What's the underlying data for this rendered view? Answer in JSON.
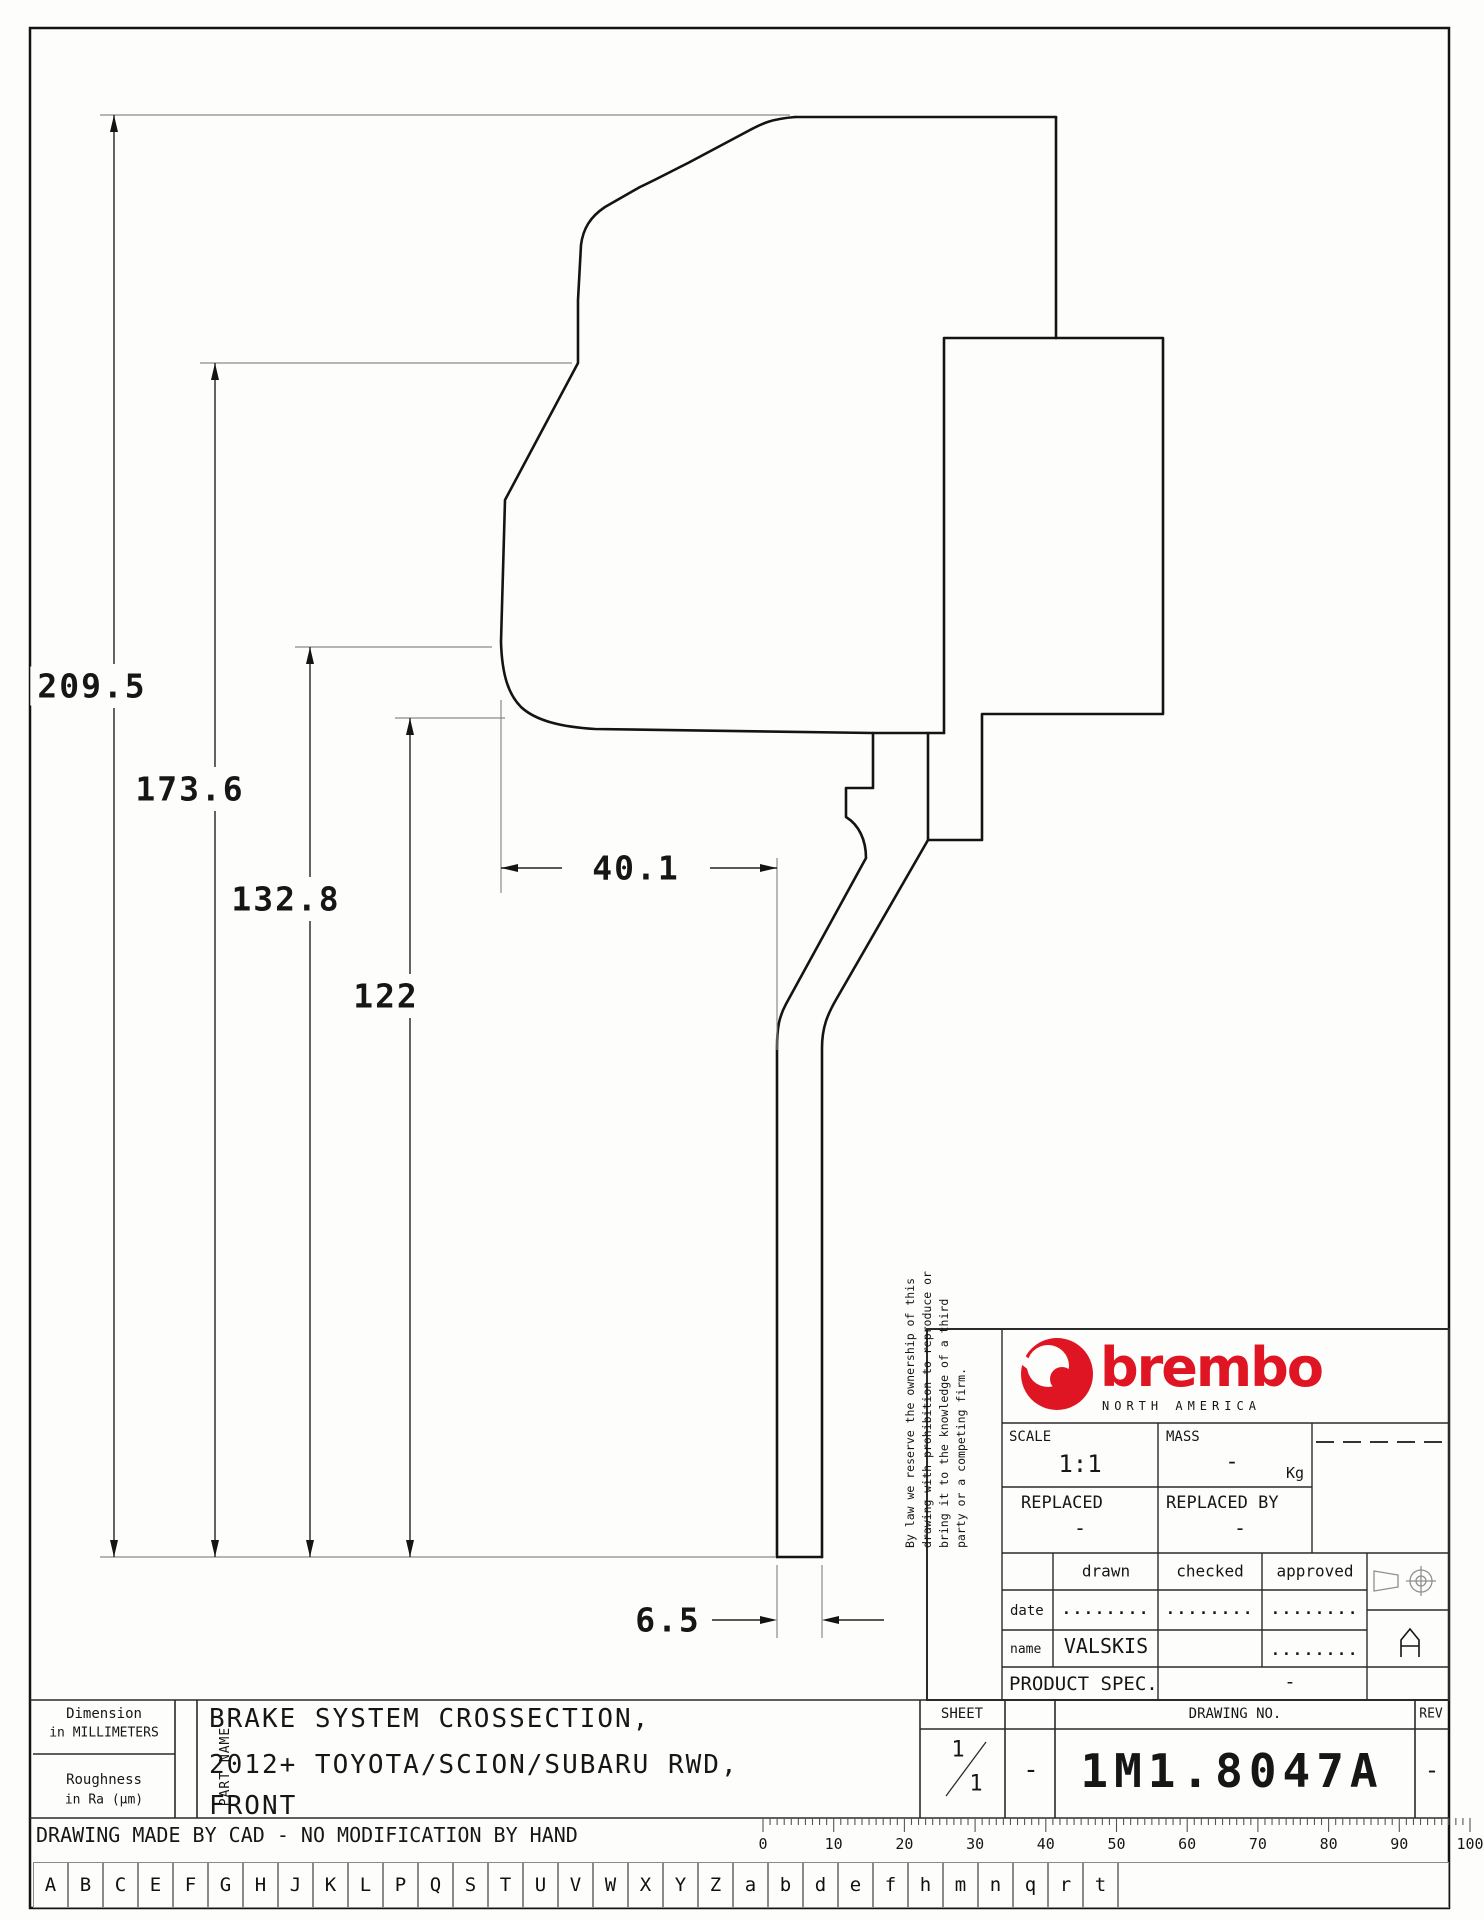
{
  "dimensions": {
    "total_height": "209.5",
    "hat_to_mid": "173.6",
    "mid_height": "132.8",
    "inner_height": "122",
    "hat_depth": "40.1",
    "vane_thickness": "6.5"
  },
  "title_block": {
    "disclaimer_lines": [
      "By law we reserve the ownership of this",
      "drawing with prohibition to reproduce or",
      "bring it to the knowledge of a third",
      "party or a competing firm."
    ],
    "brand": {
      "wordmark": "brembo",
      "region": "NORTH AMERICA"
    },
    "scale": {
      "label": "SCALE",
      "value": "1:1"
    },
    "mass": {
      "label": "MASS",
      "value": "-",
      "unit": "Kg"
    },
    "replaced": {
      "label": "REPLACED",
      "value": "-"
    },
    "replaced_by": {
      "label": "REPLACED BY",
      "value": "-"
    },
    "signoff": {
      "columns": [
        "drawn",
        "checked",
        "approved"
      ],
      "date_label": "date",
      "name_label": "name",
      "date_values": [
        "........",
        "........",
        "........"
      ],
      "name_values": [
        "VALSKIS",
        "",
        "........"
      ]
    },
    "product_spec": {
      "label": "PRODUCT SPEC.",
      "value": "-"
    },
    "sheet": {
      "label": "SHEET",
      "numerator": "1",
      "denominator": "1",
      "dash": "-"
    },
    "drawing_no": {
      "label": "DRAWING NO.",
      "value": "1M1.8047A"
    },
    "rev": {
      "label": "REV",
      "value": "-"
    }
  },
  "part_info": {
    "units_line1": "Dimension",
    "units_line2": "in MILLIMETERS",
    "roughness_line1": "Roughness",
    "roughness_line2": "in Ra (µm)",
    "part_name_label": "PART NAME",
    "part_name_lines": [
      "BRAKE SYSTEM CROSSECTION,",
      "2012+ TOYOTA/SCION/SUBARU RWD,",
      "FRONT"
    ]
  },
  "footer": {
    "note": "DRAWING MADE BY CAD - NO MODIFICATION BY HAND",
    "ruler_labels": [
      "0",
      "10",
      "20",
      "30",
      "40",
      "50",
      "60",
      "70",
      "80",
      "90",
      "100"
    ],
    "ruler_origin_x": 763,
    "ruler_mm_px": 7.07,
    "letters": [
      "A",
      "B",
      "C",
      "E",
      "F",
      "G",
      "H",
      "J",
      "K",
      "L",
      "P",
      "Q",
      "S",
      "T",
      "U",
      "V",
      "W",
      "X",
      "Y",
      "Z",
      "a",
      "b",
      "d",
      "e",
      "f",
      "h",
      "m",
      "n",
      "q",
      "r",
      "t"
    ]
  },
  "colors": {
    "brand_red": "#e01523",
    "object_line": "#141414",
    "ext_line": "#8a8a8a",
    "grid_line": "#2b2b2b"
  }
}
